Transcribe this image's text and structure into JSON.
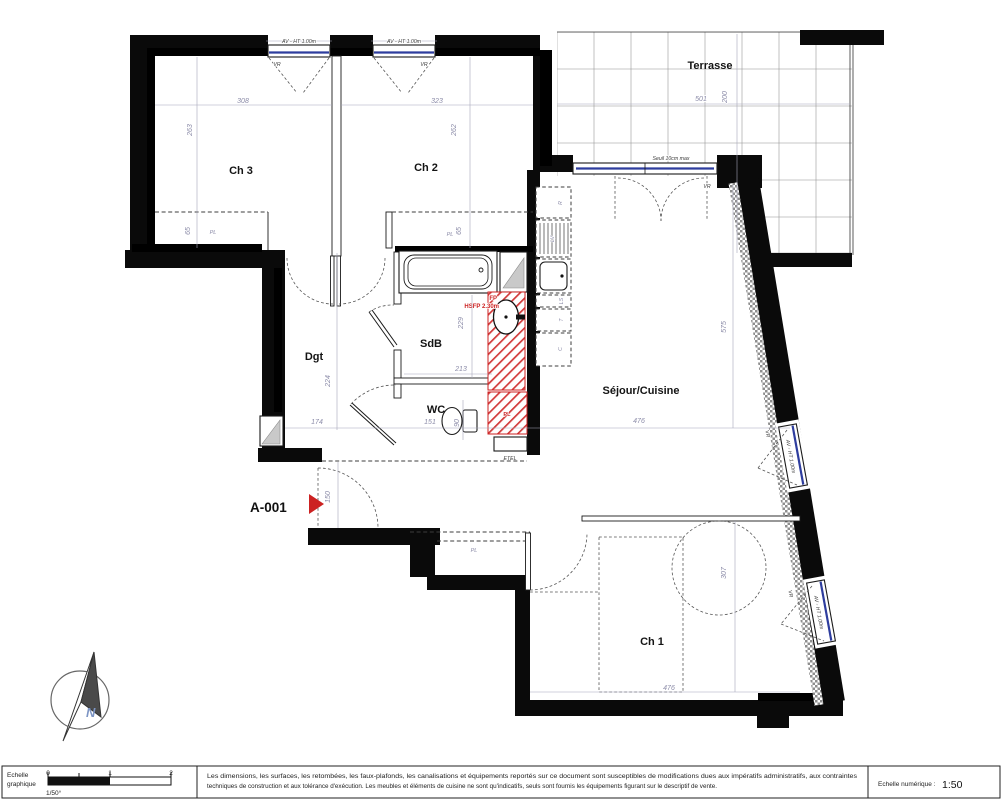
{
  "unit": {
    "label": "A-001"
  },
  "rooms": {
    "ch3": "Ch 3",
    "ch2": "Ch 2",
    "terrasse": "Terrasse",
    "dgt": "Dgt",
    "sdb": "SdB",
    "wc": "WC",
    "sejour": "Séjour/Cuisine",
    "ch1": "Ch 1"
  },
  "dims": {
    "ch3_width": "308",
    "ch3_depth": "263",
    "ch3_pl": "65",
    "ch2_width": "323",
    "ch2_depth": "262",
    "ch2_pl": "65",
    "terrasse_width": "501",
    "terrasse_depth": "200",
    "dgt_width": "174",
    "dgt_depth": "224",
    "sdb_width": "213",
    "sdb_depth": "229",
    "wc_width": "151",
    "wc_depth": "90",
    "entry_width": "150",
    "sejour_width": "476",
    "sejour_depth": "575",
    "ch1_width": "476",
    "ch1_depth": "307"
  },
  "tags": {
    "av_ht": "AV - HT 1.00m",
    "vr": "VR",
    "seuil": "Seuil 10cm max",
    "fp": "FP",
    "hsfp": "HSFP 2.30m",
    "pl": "PL",
    "etel": "ETEL"
  },
  "kitchen": {
    "fridge": "R",
    "dishwasher": "LV",
    "washer": "LS",
    "hob": "T",
    "oven": "C"
  },
  "compass": {
    "north": "N"
  },
  "footer": {
    "scale_block_line1": "Echelle",
    "scale_block_line2": "graphique",
    "scale_ratio": "1/50°",
    "tick_0": "0",
    "tick_1": "1",
    "tick_2": "2",
    "legal_line1": "Les dimensions, les surfaces, les retombées, les faux-plafonds, les canalisations et équipements reportés sur ce document sont susceptibles de modifications dues aux impératifs administratifs, aux contraintes",
    "legal_line2": "techniques de construction et aux tolérance d'exécution. Les meubles et éléments de cuisine ne sont qu'indicatifs, seuls sont fournis les équipements figurant sur le descriptif de vente.",
    "numeric_scale_label": "Echelle numérique :",
    "numeric_scale_value": "1:50"
  },
  "colors": {
    "wall": "#0a0a0a",
    "window_frame": "#2e3d9e",
    "duct_red": "#cc2222",
    "dimension_text": "#8b8ba8"
  }
}
